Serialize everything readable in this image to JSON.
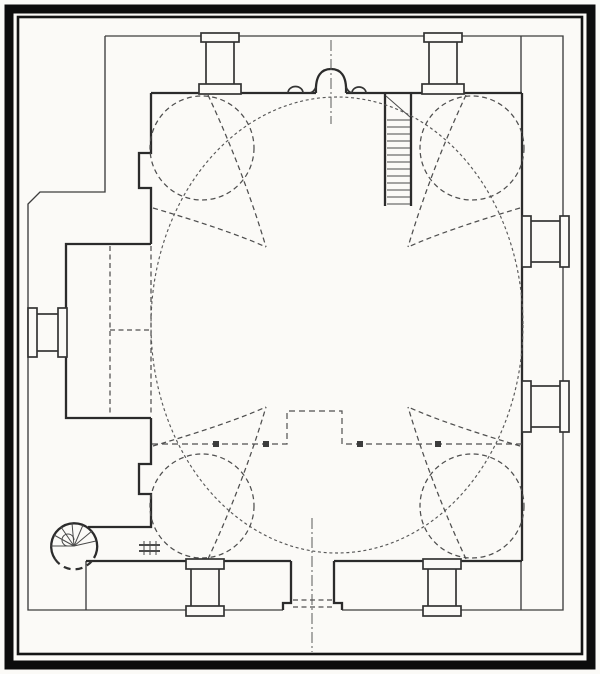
{
  "meta": {
    "figure_kind": "scanned architectural floor plan",
    "visible_text": ""
  },
  "canvas": {
    "w": 600,
    "h": 674,
    "paper": "#fbfaf7",
    "ink": "#2c2c2c"
  },
  "styles": {
    "wall": {
      "stroke": "#2b2b2b",
      "width": 2.3
    },
    "wall2": {
      "stroke": "#343434",
      "width": 1.7
    },
    "thin": {
      "stroke": "#3d3d3d",
      "width": 1.35
    },
    "tread": {
      "stroke": "#4a4a4a",
      "width": 1
    },
    "dash": {
      "stroke": "#4f4f4f",
      "width": 1.25,
      "dash": "5 3.5"
    },
    "gdash": {
      "stroke": "#4f4f4f",
      "width": 1.2,
      "dash": "6 4"
    },
    "fdash": {
      "stroke": "#585858",
      "width": 1.15,
      "dash": "3 2.7"
    },
    "bdash": {
      "stroke": "#303030",
      "width": 2.2,
      "dash": "7 5"
    },
    "axis": {
      "stroke": "#5a5a5a",
      "width": 1,
      "dash": "11 3 2 3"
    },
    "b9": {
      "stroke": "#0c0c0c",
      "width": 9
    },
    "b2": {
      "stroke": "#141414",
      "width": 2.6
    },
    "post": {
      "stroke": "none",
      "width": 0,
      "fill": "#3c3c3c"
    }
  },
  "shapes": [
    {
      "k": "rect",
      "n": "photo-border-outer",
      "x": 9,
      "y": 9,
      "w": 582,
      "h": 656,
      "s": "b9"
    },
    {
      "k": "rect",
      "n": "photo-border-inner",
      "x": 18,
      "y": 17,
      "w": 564,
      "h": 637,
      "s": "b2"
    },
    {
      "k": "poly",
      "n": "precinct-outline-top-right",
      "pts": "105,36 563,36 563,610 342,610",
      "s": "thin"
    },
    {
      "k": "poly",
      "n": "precinct-outline-bottom-left",
      "pts": "283,610 28,610 28,204 40,192 105,192 105,36",
      "s": "thin"
    },
    {
      "k": "line",
      "n": "portico-end-wall-top-right",
      "x1": 521,
      "y1": 36,
      "x2": 521,
      "y2": 93,
      "s": "thin"
    },
    {
      "k": "line",
      "n": "portico-end-wall-bottom-right",
      "x1": 521,
      "y1": 561,
      "x2": 521,
      "y2": 610,
      "s": "thin"
    },
    {
      "k": "line",
      "n": "portico-end-wall-bottom-left",
      "x1": 86,
      "y1": 561,
      "x2": 86,
      "y2": 610,
      "s": "thin"
    },
    {
      "k": "line",
      "n": "qibla-wall-left",
      "x1": 151,
      "y1": 93,
      "x2": 316,
      "y2": 93,
      "s": "wall"
    },
    {
      "k": "line",
      "n": "qibla-wall-right",
      "x1": 346,
      "y1": 93,
      "x2": 522,
      "y2": 93,
      "s": "wall"
    },
    {
      "k": "path",
      "n": "mihrab-niche",
      "d": "M 316,93 C 315,75 322,69 331,69 C 340,69 347,75 346,93",
      "s": "wall"
    },
    {
      "k": "path",
      "n": "mihrab-shoulder-left",
      "d": "M 310,93 Q 314,92 316,87",
      "s": "wall2"
    },
    {
      "k": "path",
      "n": "mihrab-shoulder-right",
      "d": "M 346,87 Q 348,92 352,93",
      "s": "wall2"
    },
    {
      "k": "path",
      "n": "wall-niche-scallop-left",
      "d": "M 288,93 A 7.5 6.5 0 0 1 303,93",
      "s": "wall2"
    },
    {
      "k": "path",
      "n": "wall-niche-scallop-right",
      "d": "M 352,93 A 7 6 0 0 1 366,93",
      "s": "wall2"
    },
    {
      "k": "line",
      "n": "east-wall",
      "x1": 522,
      "y1": 93,
      "x2": 522,
      "y2": 561,
      "s": "wall"
    },
    {
      "k": "line",
      "n": "south-wall-left",
      "x1": 86,
      "y1": 561,
      "x2": 291,
      "y2": 561,
      "s": "wall"
    },
    {
      "k": "line",
      "n": "south-wall-right",
      "x1": 334,
      "y1": 561,
      "x2": 522,
      "y2": 561,
      "s": "wall"
    },
    {
      "k": "poly",
      "n": "west-wall-upper-with-pilaster",
      "pts": "151,93 151,153 139,153 139,188 151,188 151,244",
      "s": "wall"
    },
    {
      "k": "line",
      "n": "west-wall-arch-opening-dashed",
      "x1": 151,
      "y1": 246,
      "x2": 151,
      "y2": 416,
      "s": "dash"
    },
    {
      "k": "poly",
      "n": "west-wall-lower-with-pilaster",
      "pts": "151,418 151,464 139,464 139,494 151,494 151,527 88,527",
      "s": "wall"
    },
    {
      "k": "poly",
      "n": "annex-room-walls",
      "pts": "151,244 66,244 66,418 151,418",
      "s": "wall"
    },
    {
      "k": "line",
      "n": "annex-partition-dashed-vertical",
      "x1": 110,
      "y1": 246,
      "x2": 110,
      "y2": 416,
      "s": "dash"
    },
    {
      "k": "line",
      "n": "annex-partition-dashed-horizontal",
      "x1": 110,
      "y1": 330,
      "x2": 151,
      "y2": 330,
      "s": "dash"
    },
    {
      "k": "poly",
      "n": "entrance-jamb-left",
      "pts": "291,561 291,603 283,603 283,610",
      "s": "wall"
    },
    {
      "k": "poly",
      "n": "entrance-jamb-right",
      "pts": "334,561 334,603 342,603 342,610",
      "s": "wall"
    },
    {
      "k": "line",
      "n": "entrance-threshold-dash-1",
      "x1": 293,
      "y1": 600,
      "x2": 333,
      "y2": 600,
      "s": "dash"
    },
    {
      "k": "line",
      "n": "entrance-threshold-dash-2",
      "x1": 293,
      "y1": 607,
      "x2": 333,
      "y2": 607,
      "s": "dash"
    },
    {
      "k": "line",
      "n": "entrance-axis-line",
      "x1": 312,
      "y1": 518,
      "x2": 312,
      "y2": 652,
      "s": "axis"
    },
    {
      "k": "line",
      "n": "mihrab-axis-line",
      "x1": 331,
      "y1": 40,
      "x2": 331,
      "y2": 124,
      "s": "axis"
    },
    {
      "k": "line",
      "n": "stair-shaft-wall-left",
      "x1": 385,
      "y1": 93,
      "x2": 385,
      "y2": 206,
      "s": "wall"
    },
    {
      "k": "line",
      "n": "stair-shaft-wall-right",
      "x1": 411,
      "y1": 93,
      "x2": 411,
      "y2": 206,
      "s": "wall"
    },
    {
      "k": "line",
      "n": "stair-landing-diagonal",
      "x1": 386,
      "y1": 96,
      "x2": 410,
      "y2": 117,
      "s": "tread"
    },
    {
      "k": "line",
      "n": "stair-tread",
      "x1": 387,
      "y1": 120,
      "x2": 410,
      "y2": 120,
      "s": "tread"
    },
    {
      "k": "line",
      "n": "stair-tread",
      "x1": 387,
      "y1": 127,
      "x2": 410,
      "y2": 127,
      "s": "tread"
    },
    {
      "k": "line",
      "n": "stair-tread",
      "x1": 387,
      "y1": 134,
      "x2": 410,
      "y2": 134,
      "s": "tread"
    },
    {
      "k": "line",
      "n": "stair-tread",
      "x1": 387,
      "y1": 141,
      "x2": 410,
      "y2": 141,
      "s": "tread"
    },
    {
      "k": "line",
      "n": "stair-tread",
      "x1": 387,
      "y1": 148,
      "x2": 410,
      "y2": 148,
      "s": "tread"
    },
    {
      "k": "line",
      "n": "stair-tread",
      "x1": 387,
      "y1": 155,
      "x2": 410,
      "y2": 155,
      "s": "tread"
    },
    {
      "k": "line",
      "n": "stair-tread",
      "x1": 387,
      "y1": 162,
      "x2": 410,
      "y2": 162,
      "s": "tread"
    },
    {
      "k": "line",
      "n": "stair-tread",
      "x1": 387,
      "y1": 169,
      "x2": 410,
      "y2": 169,
      "s": "tread"
    },
    {
      "k": "line",
      "n": "stair-tread",
      "x1": 387,
      "y1": 176,
      "x2": 410,
      "y2": 176,
      "s": "tread"
    },
    {
      "k": "line",
      "n": "stair-tread",
      "x1": 387,
      "y1": 183,
      "x2": 410,
      "y2": 183,
      "s": "tread"
    },
    {
      "k": "line",
      "n": "stair-tread",
      "x1": 387,
      "y1": 190,
      "x2": 410,
      "y2": 190,
      "s": "tread"
    },
    {
      "k": "line",
      "n": "stair-tread",
      "x1": 387,
      "y1": 197,
      "x2": 410,
      "y2": 197,
      "s": "tread"
    },
    {
      "k": "line",
      "n": "stair-tread",
      "x1": 387,
      "y1": 204,
      "x2": 410,
      "y2": 204,
      "s": "tread"
    },
    {
      "k": "ellipse",
      "n": "oval-dome-outline",
      "cx": 337,
      "cy": 325,
      "rx": 186,
      "ry": 228,
      "s": "fdash"
    },
    {
      "k": "circle",
      "n": "corner-exedra-top-left",
      "cx": 202,
      "cy": 148,
      "r": 52,
      "s": "dash"
    },
    {
      "k": "circle",
      "n": "corner-exedra-top-right",
      "cx": 472,
      "cy": 148,
      "r": 52,
      "s": "dash"
    },
    {
      "k": "circle",
      "n": "corner-exedra-bottom-left",
      "cx": 202,
      "cy": 506,
      "r": 52,
      "s": "dash"
    },
    {
      "k": "circle",
      "n": "corner-exedra-bottom-right",
      "cx": 472,
      "cy": 506,
      "r": 52,
      "s": "dash"
    },
    {
      "k": "path",
      "n": "pendentive-arc",
      "d": "M 208,95 Q 243,170 266,247",
      "s": "dash"
    },
    {
      "k": "path",
      "n": "pendentive-arc",
      "d": "M 153,208 Q 228,230 266,247",
      "s": "dash"
    },
    {
      "k": "path",
      "n": "pendentive-arc",
      "d": "M 466,95 Q 431,170 408,247",
      "s": "dash"
    },
    {
      "k": "path",
      "n": "pendentive-arc",
      "d": "M 520,208 Q 446,230 408,247",
      "s": "dash"
    },
    {
      "k": "path",
      "n": "pendentive-arc",
      "d": "M 208,559 Q 243,484 266,407",
      "s": "dash"
    },
    {
      "k": "path",
      "n": "pendentive-arc",
      "d": "M 153,446 Q 228,424 266,407",
      "s": "dash"
    },
    {
      "k": "path",
      "n": "pendentive-arc",
      "d": "M 466,559 Q 431,484 408,407",
      "s": "dash"
    },
    {
      "k": "path",
      "n": "pendentive-arc",
      "d": "M 520,446 Q 446,424 408,407",
      "s": "dash"
    },
    {
      "k": "poly",
      "n": "gallery-edge-dashed",
      "pts": "152,444 287,444 287,411 342,411 342,444 522,444",
      "s": "gdash"
    },
    {
      "k": "rect",
      "n": "gallery-post",
      "x": 213,
      "y": 441,
      "w": 6,
      "h": 6,
      "s": "post"
    },
    {
      "k": "rect",
      "n": "gallery-post",
      "x": 263,
      "y": 441,
      "w": 6,
      "h": 6,
      "s": "post"
    },
    {
      "k": "rect",
      "n": "gallery-post",
      "x": 357,
      "y": 441,
      "w": 6,
      "h": 6,
      "s": "post"
    },
    {
      "k": "rect",
      "n": "gallery-post",
      "x": 435,
      "y": 441,
      "w": 6,
      "h": 6,
      "s": "post"
    },
    {
      "k": "rect",
      "n": "pier-north-left-shaft",
      "x": 206,
      "y": 41,
      "w": 28,
      "h": 50,
      "s": "wall2",
      "f": "paper"
    },
    {
      "k": "rect",
      "n": "pier-north-left-cap",
      "x": 201,
      "y": 33,
      "w": 38,
      "h": 9,
      "s": "wall2",
      "f": "paper"
    },
    {
      "k": "rect",
      "n": "pier-north-left-base",
      "x": 199,
      "y": 84,
      "w": 42,
      "h": 10,
      "s": "wall2",
      "f": "paper"
    },
    {
      "k": "rect",
      "n": "pier-north-right-shaft",
      "x": 429,
      "y": 41,
      "w": 28,
      "h": 50,
      "s": "wall2",
      "f": "paper"
    },
    {
      "k": "rect",
      "n": "pier-north-right-cap",
      "x": 424,
      "y": 33,
      "w": 38,
      "h": 9,
      "s": "wall2",
      "f": "paper"
    },
    {
      "k": "rect",
      "n": "pier-north-right-base",
      "x": 422,
      "y": 84,
      "w": 42,
      "h": 10,
      "s": "wall2",
      "f": "paper"
    },
    {
      "k": "rect",
      "n": "pier-south-left-shaft",
      "x": 191,
      "y": 568,
      "w": 28,
      "h": 42,
      "s": "wall2",
      "f": "paper"
    },
    {
      "k": "rect",
      "n": "pier-south-left-cap",
      "x": 186,
      "y": 559,
      "w": 38,
      "h": 10,
      "s": "wall2",
      "f": "paper"
    },
    {
      "k": "rect",
      "n": "pier-south-left-base",
      "x": 186,
      "y": 606,
      "w": 38,
      "h": 10,
      "s": "wall2",
      "f": "paper"
    },
    {
      "k": "rect",
      "n": "pier-south-right-shaft",
      "x": 428,
      "y": 568,
      "w": 28,
      "h": 42,
      "s": "wall2",
      "f": "paper"
    },
    {
      "k": "rect",
      "n": "pier-south-right-cap",
      "x": 423,
      "y": 559,
      "w": 38,
      "h": 10,
      "s": "wall2",
      "f": "paper"
    },
    {
      "k": "rect",
      "n": "pier-south-right-base",
      "x": 423,
      "y": 606,
      "w": 38,
      "h": 10,
      "s": "wall2",
      "f": "paper"
    },
    {
      "k": "rect",
      "n": "pier-east-upper-shaft",
      "x": 530,
      "y": 221,
      "w": 32,
      "h": 41,
      "s": "wall2",
      "f": "paper"
    },
    {
      "k": "rect",
      "n": "pier-east-upper-cap",
      "x": 522,
      "y": 216,
      "w": 9,
      "h": 51,
      "s": "wall2",
      "f": "paper"
    },
    {
      "k": "rect",
      "n": "pier-east-upper-base",
      "x": 560,
      "y": 216,
      "w": 9,
      "h": 51,
      "s": "wall2",
      "f": "paper"
    },
    {
      "k": "rect",
      "n": "pier-east-lower-shaft",
      "x": 530,
      "y": 386,
      "w": 32,
      "h": 41,
      "s": "wall2",
      "f": "paper"
    },
    {
      "k": "rect",
      "n": "pier-east-lower-cap",
      "x": 522,
      "y": 381,
      "w": 9,
      "h": 51,
      "s": "wall2",
      "f": "paper"
    },
    {
      "k": "rect",
      "n": "pier-east-lower-base",
      "x": 560,
      "y": 381,
      "w": 9,
      "h": 51,
      "s": "wall2",
      "f": "paper"
    },
    {
      "k": "rect",
      "n": "pier-annex-west-shaft",
      "x": 36,
      "y": 314,
      "w": 28,
      "h": 37,
      "s": "wall2",
      "f": "paper"
    },
    {
      "k": "rect",
      "n": "pier-annex-west-cap",
      "x": 28,
      "y": 308,
      "w": 9,
      "h": 49,
      "s": "wall2",
      "f": "paper"
    },
    {
      "k": "rect",
      "n": "pier-annex-west-base",
      "x": 58,
      "y": 308,
      "w": 9,
      "h": 49,
      "s": "wall2",
      "f": "paper"
    },
    {
      "k": "path",
      "n": "spiral-stair-outline-solid",
      "d": "M 94,558 A 23 23 0 1 0 55,559",
      "s": "wall"
    },
    {
      "k": "path",
      "n": "spiral-stair-outline-dashed",
      "d": "M 55,559 A 23 23 0 0 0 94,558",
      "s": "bdash"
    },
    {
      "k": "line",
      "n": "spiral-stair-tread",
      "x1": 74,
      "y1": 546,
      "x2": 96,
      "y2": 541,
      "s": "tread"
    },
    {
      "k": "line",
      "n": "spiral-stair-tread",
      "x1": 74,
      "y1": 546,
      "x2": 92,
      "y2": 531,
      "s": "tread"
    },
    {
      "k": "line",
      "n": "spiral-stair-tread",
      "x1": 74,
      "y1": 546,
      "x2": 83,
      "y2": 525,
      "s": "tread"
    },
    {
      "k": "line",
      "n": "spiral-stair-tread",
      "x1": 74,
      "y1": 546,
      "x2": 72,
      "y2": 523,
      "s": "tread"
    },
    {
      "k": "line",
      "n": "spiral-stair-tread",
      "x1": 74,
      "y1": 546,
      "x2": 61,
      "y2": 527,
      "s": "tread"
    },
    {
      "k": "line",
      "n": "spiral-stair-tread",
      "x1": 74,
      "y1": 546,
      "x2": 54,
      "y2": 535,
      "s": "tread"
    },
    {
      "k": "line",
      "n": "spiral-stair-tread",
      "x1": 74,
      "y1": 546,
      "x2": 51,
      "y2": 546,
      "s": "tread"
    },
    {
      "k": "path",
      "n": "spiral-stair-newel",
      "d": "M 74,540 A 6 6 0 1 0 68,546",
      "s": "tread"
    },
    {
      "k": "line",
      "n": "stair-door-sill-line-1",
      "x1": 139,
      "y1": 545,
      "x2": 160,
      "y2": 545,
      "s": "wall2"
    },
    {
      "k": "line",
      "n": "stair-door-sill-line-2",
      "x1": 139,
      "y1": 551,
      "x2": 160,
      "y2": 551,
      "s": "wall2"
    },
    {
      "k": "line",
      "n": "stair-door-sill-tick",
      "x1": 144,
      "y1": 541,
      "x2": 144,
      "y2": 555,
      "s": "tread"
    },
    {
      "k": "line",
      "n": "stair-door-sill-tick",
      "x1": 150,
      "y1": 541,
      "x2": 150,
      "y2": 555,
      "s": "tread"
    },
    {
      "k": "line",
      "n": "stair-door-sill-tick",
      "x1": 156,
      "y1": 541,
      "x2": 156,
      "y2": 555,
      "s": "tread"
    }
  ]
}
